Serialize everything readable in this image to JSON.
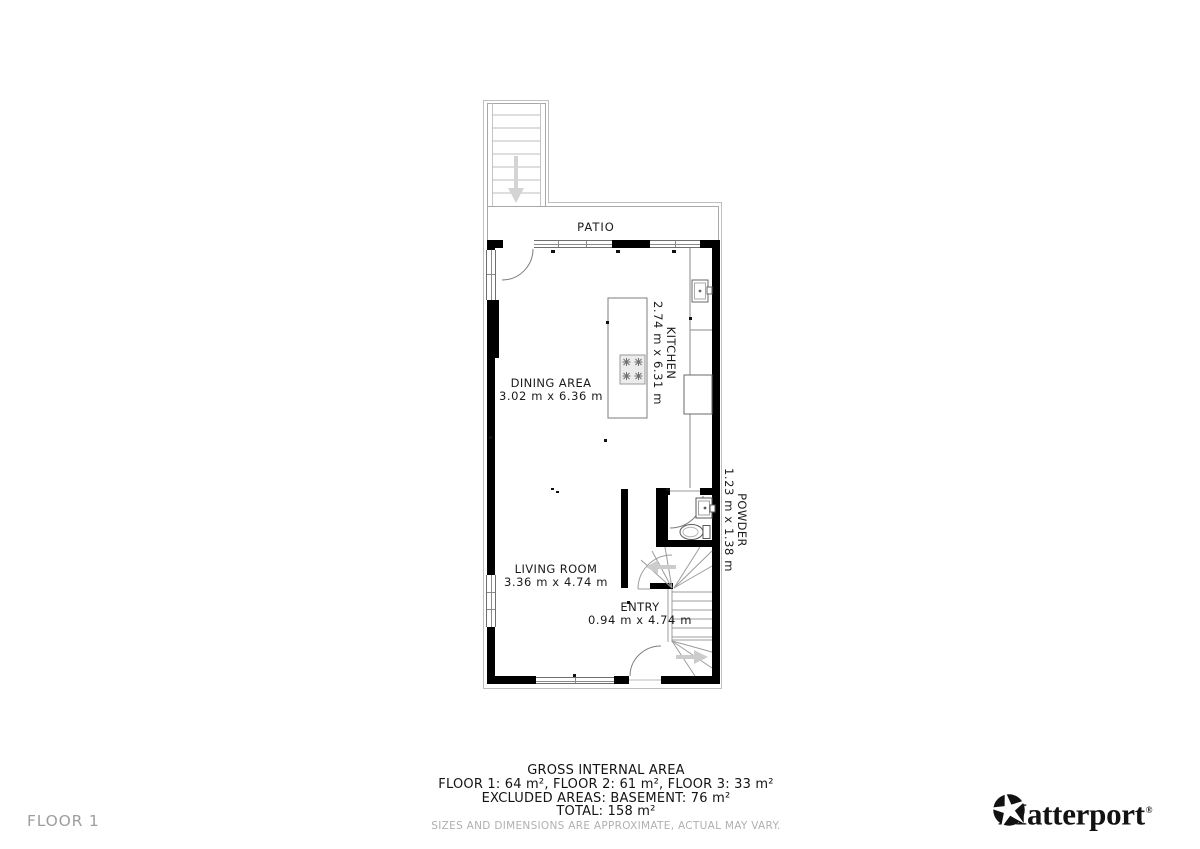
{
  "floorplan": {
    "patio_label": "PATIO",
    "rooms": {
      "kitchen": {
        "name": "KITCHEN",
        "dims": "2.74 m x 6.31 m"
      },
      "dining": {
        "name": "DINING AREA",
        "dims": "3.02 m x 6.36 m"
      },
      "powder": {
        "name": "POWDER",
        "dims": "1.23 m x 1.38 m"
      },
      "living": {
        "name": "LIVING ROOM",
        "dims": "3.36 m x 4.74 m"
      },
      "entry": {
        "name": "ENTRY",
        "dims": "0.94 m x 4.74 m"
      }
    },
    "icons": [
      "stairs-down-arrow-icon",
      "stairs-up-arrow-icon",
      "door-swing-arc-icon",
      "toilet-icon",
      "sink-icon",
      "cooktop-icon",
      "fridge-icon"
    ]
  },
  "footer": {
    "title": "GROSS INTERNAL AREA",
    "areas_line": "FLOOR 1: 64 m², FLOOR 2: 61 m², FLOOR 3: 33 m²",
    "excluded_line": "EXCLUDED AREAS: BASEMENT: 76 m²",
    "total_line": "TOTAL: 158 m²",
    "disclaimer": "SIZES AND DIMENSIONS ARE APPROXIMATE, ACTUAL MAY VARY."
  },
  "floor_label": "FLOOR 1",
  "brand": {
    "name": "Matterport",
    "reg": "®",
    "icon": "matterport-pinwheel-icon"
  },
  "colors": {
    "wall": "#000000",
    "furniture_line": "#777777",
    "patio_line": "#a8a8a8",
    "arrow": "#cccccc",
    "text": "#1b1b1b",
    "muted_text": "#9e9e9e"
  }
}
